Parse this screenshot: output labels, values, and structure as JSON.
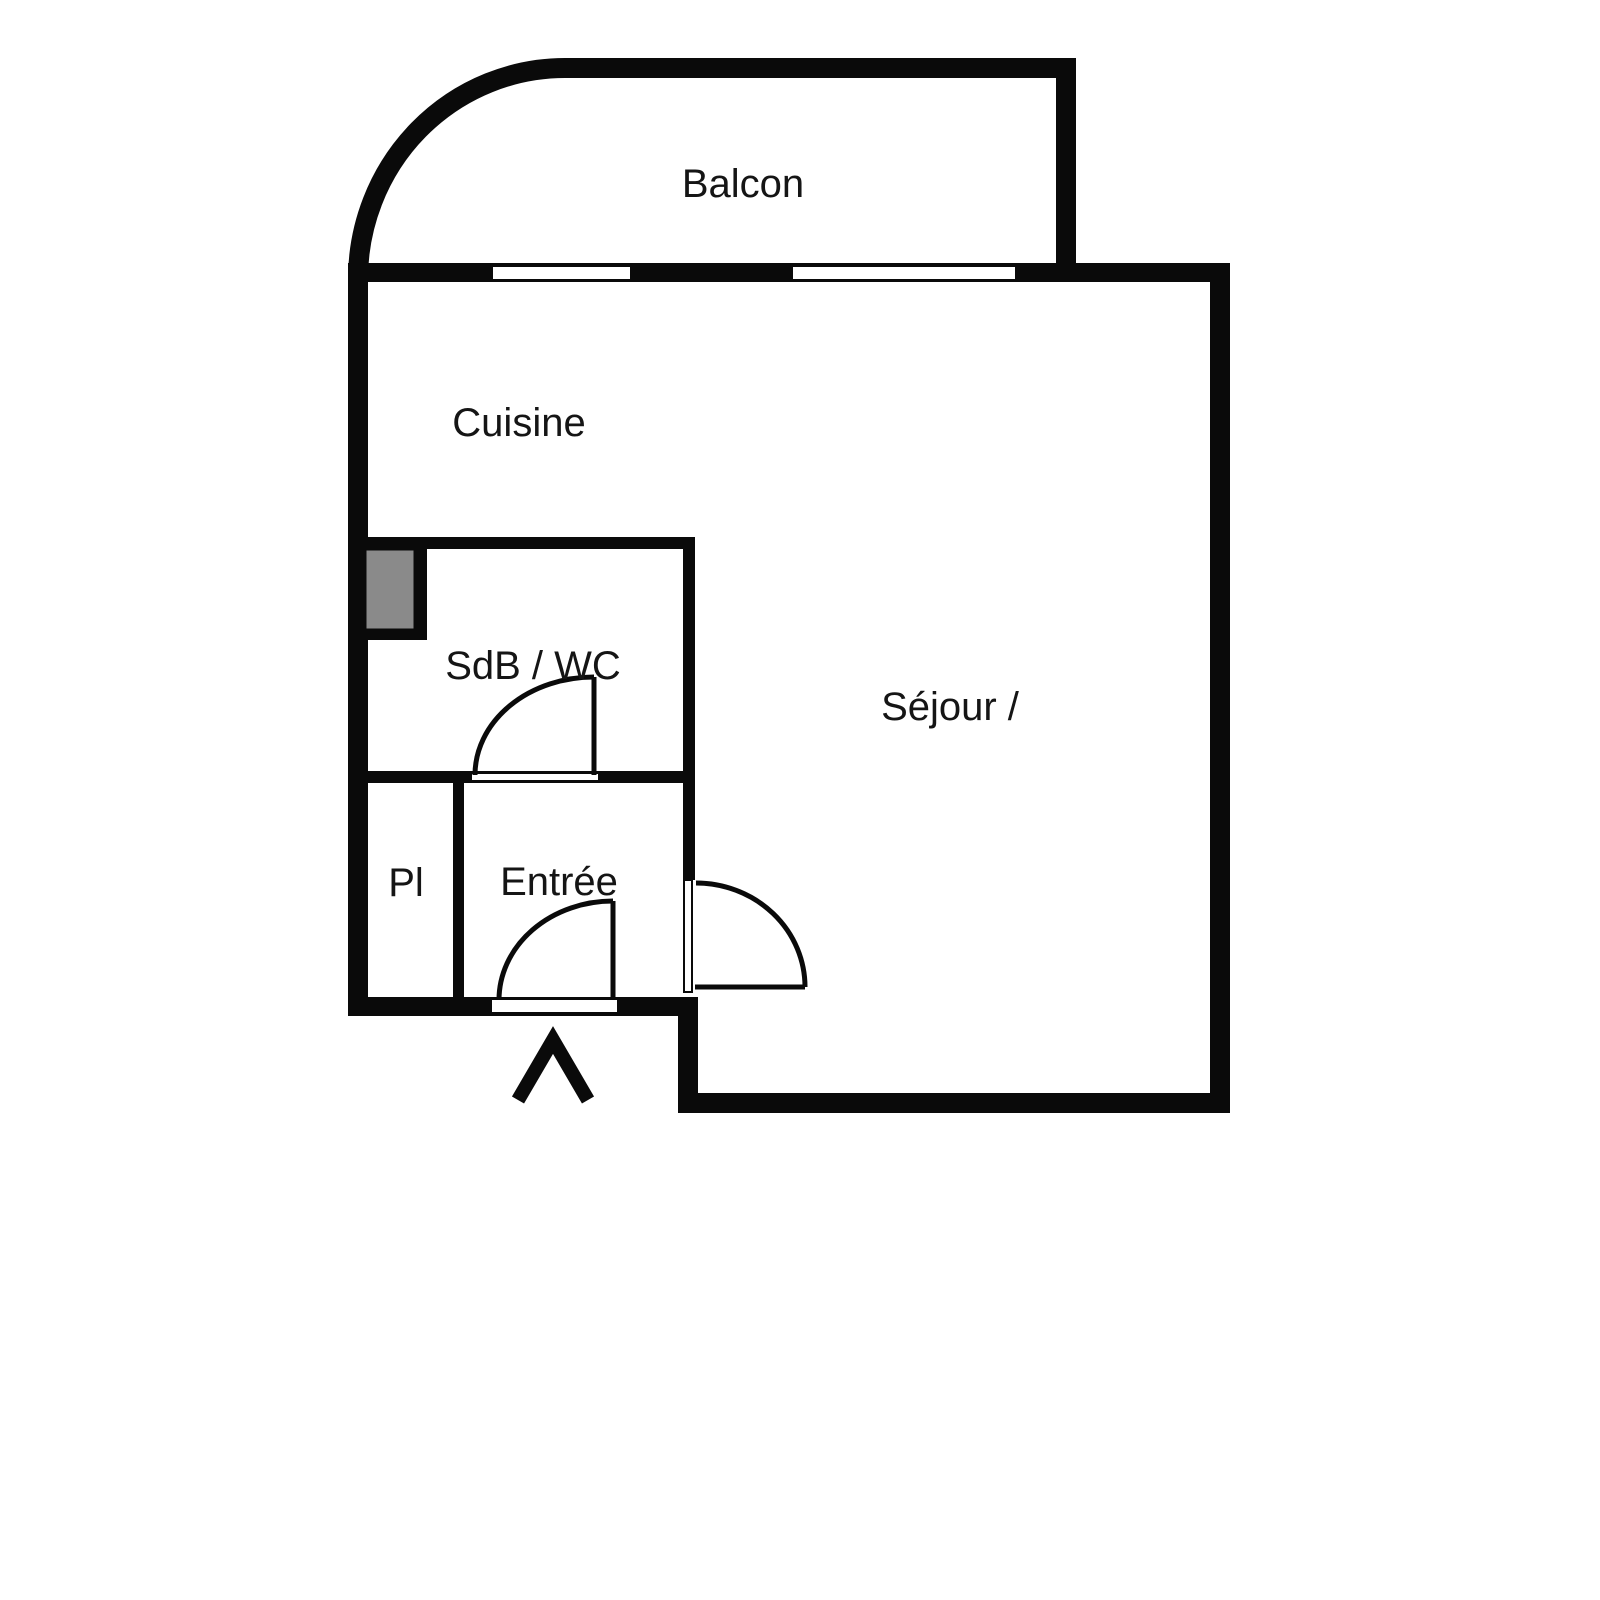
{
  "floorplan": {
    "kind": "apartment-floor-plan",
    "background": "#ffffff",
    "wall_color": "#0a0a0a",
    "duct_color": "#8a8a8a",
    "rooms": [
      {
        "id": "balcon",
        "label": "Balcon"
      },
      {
        "id": "cuisine",
        "label": "Cuisine"
      },
      {
        "id": "sdb_wc",
        "label": "SdB / WC"
      },
      {
        "id": "sejour",
        "label": "Séjour /"
      },
      {
        "id": "pl",
        "label": "Pl"
      },
      {
        "id": "entree",
        "label": "Entrée"
      }
    ],
    "features": {
      "door_count": 3,
      "window_count": 2,
      "entrance_marker": "chevron-up-arrow"
    }
  }
}
